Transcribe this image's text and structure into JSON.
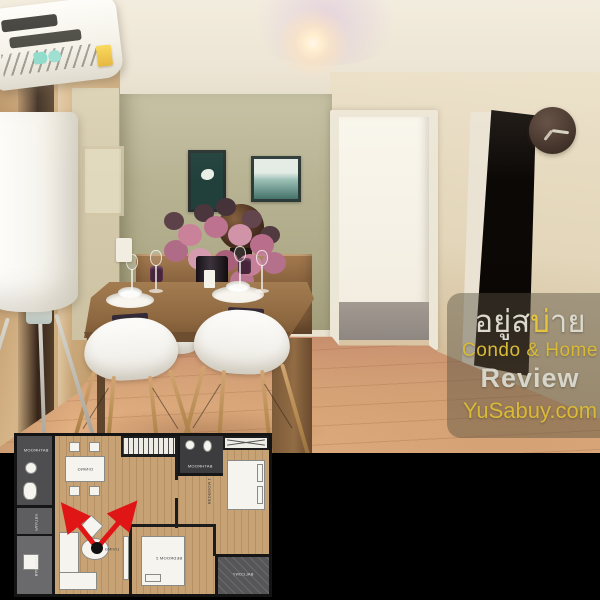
{
  "watermark": {
    "brand_thai_prefix": "อยู่ส",
    "brand_thai_accent": "บ่",
    "brand_thai_suffix": "าย",
    "line_condo_home": "Condo & Home",
    "line_review": "Review",
    "line_site": "YuSabuy.com",
    "accent_yellow": "#d9ba36",
    "text_gray": "#d7d4ca",
    "panel_color": "rgba(86,80,64,0.45)"
  },
  "floorplan": {
    "arrow_color": "#e01616",
    "camera_dot_color": "#111111",
    "labels": {
      "bathroom_a": "BATHROOM",
      "dining": "DINING",
      "pantry": "PANTRY",
      "balcony_a": "BALCONY",
      "living": "LIVING",
      "bedroom_1": "BEDROOM 1",
      "bedroom_2": "BEDROOM 2",
      "bathroom_b": "BATHROOM",
      "balcony_b": "BALCONY"
    }
  },
  "scene_colors": {
    "wall_green": "#afab89",
    "wall_cream": "#e3d6ba",
    "wall_tan_gloss": "#d6b689",
    "floor_wood": "#d8a57a",
    "clock_body": "#3e2d24",
    "chair_white": "#f3f1ec",
    "flower_pink": "#c9829a",
    "ac_sticker_yellow": "#f8d441"
  }
}
